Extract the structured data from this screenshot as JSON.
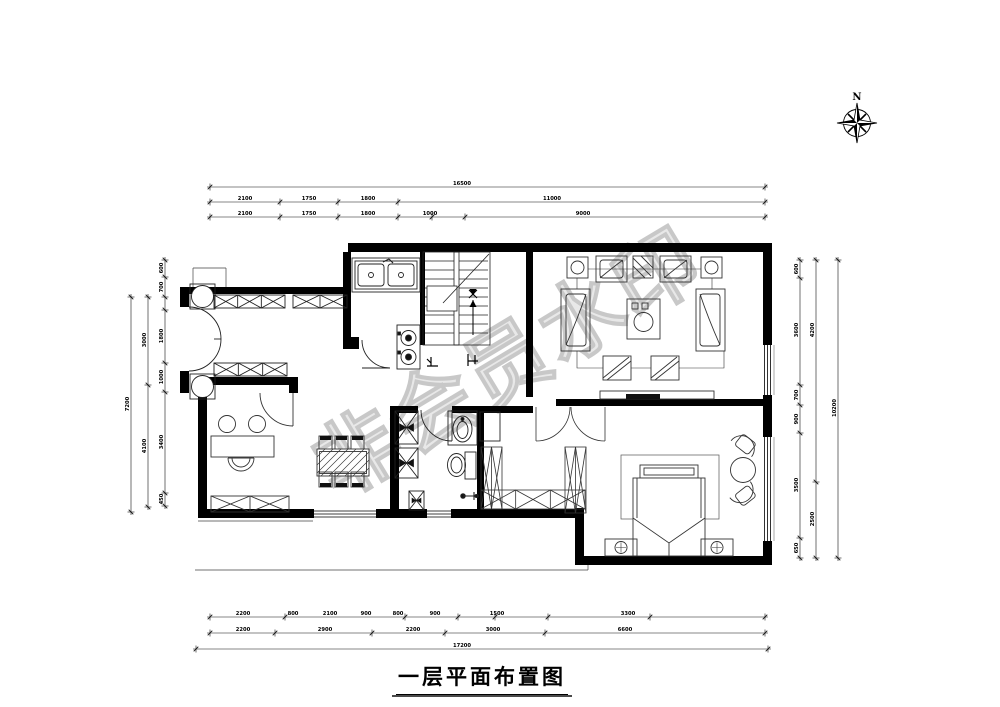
{
  "title": {
    "text": "一层平面布置图"
  },
  "compass": {
    "label": "N"
  },
  "watermark": {
    "text": "非会员水印"
  },
  "colors": {
    "line": "#000000",
    "furniture": "#333333",
    "watermark": "#c3c3c3"
  },
  "dimensions": {
    "lines": [
      {
        "o": "h",
        "y": 187,
        "a": 210,
        "b": 765,
        "ticks": [
          210,
          765
        ],
        "labels": [
          {
            "p": 462,
            "t": "16500"
          }
        ]
      },
      {
        "o": "h",
        "y": 202,
        "a": 210,
        "b": 765,
        "ticks": [
          210,
          280,
          338,
          398,
          765
        ],
        "labels": [
          {
            "p": 245,
            "t": "2100"
          },
          {
            "p": 309,
            "t": "1750"
          },
          {
            "p": 368,
            "t": "1800"
          },
          {
            "p": 552,
            "t": "11000"
          }
        ]
      },
      {
        "o": "h",
        "y": 217,
        "a": 210,
        "b": 765,
        "ticks": [
          210,
          280,
          338,
          398,
          432,
          465,
          765
        ],
        "labels": [
          {
            "p": 245,
            "t": "2100"
          },
          {
            "p": 309,
            "t": "1750"
          },
          {
            "p": 368,
            "t": "1800"
          },
          {
            "p": 430,
            "t": "1000"
          },
          {
            "p": 583,
            "t": "9000"
          }
        ]
      },
      {
        "o": "h",
        "y": 617,
        "a": 210,
        "b": 765,
        "ticks": [
          210,
          285,
          405,
          458,
          495,
          548,
          650,
          765
        ],
        "labels": [
          {
            "p": 243,
            "t": "2200"
          },
          {
            "p": 293,
            "t": "800"
          },
          {
            "p": 330,
            "t": "2100"
          },
          {
            "p": 366,
            "t": "900"
          },
          {
            "p": 398,
            "t": "800"
          },
          {
            "p": 435,
            "t": "900"
          },
          {
            "p": 497,
            "t": "1500"
          },
          {
            "p": 628,
            "t": "3300"
          }
        ]
      },
      {
        "o": "h",
        "y": 633,
        "a": 210,
        "b": 765,
        "ticks": [
          210,
          275,
          372,
          445,
          545,
          765
        ],
        "labels": [
          {
            "p": 243,
            "t": "2200"
          },
          {
            "p": 325,
            "t": "2900"
          },
          {
            "p": 413,
            "t": "2200"
          },
          {
            "p": 493,
            "t": "3000"
          },
          {
            "p": 625,
            "t": "6600"
          }
        ]
      },
      {
        "o": "h",
        "y": 649,
        "a": 196,
        "b": 768,
        "ticks": [
          196,
          768
        ],
        "labels": [
          {
            "p": 462,
            "t": "17200"
          }
        ]
      },
      {
        "o": "v",
        "x": 165,
        "a": 260,
        "b": 506,
        "ticks": [
          260,
          277,
          297,
          310,
          363,
          392,
          493,
          506
        ],
        "labels": [
          {
            "p": 268,
            "t": "600"
          },
          {
            "p": 287,
            "t": "700"
          },
          {
            "p": 336,
            "t": "1800"
          },
          {
            "p": 377,
            "t": "1000"
          },
          {
            "p": 442,
            "t": "3400"
          },
          {
            "p": 499,
            "t": "450"
          }
        ]
      },
      {
        "o": "v",
        "x": 148,
        "a": 297,
        "b": 507,
        "ticks": [
          297,
          385,
          507
        ],
        "labels": [
          {
            "p": 340,
            "t": "3000"
          },
          {
            "p": 446,
            "t": "4100"
          }
        ]
      },
      {
        "o": "v",
        "x": 131,
        "a": 297,
        "b": 512,
        "ticks": [
          297,
          512
        ],
        "labels": [
          {
            "p": 404,
            "t": "7200"
          }
        ]
      },
      {
        "o": "v",
        "x": 800,
        "a": 260,
        "b": 558,
        "ticks": [
          260,
          278,
          385,
          405,
          433,
          538,
          558
        ],
        "labels": [
          {
            "p": 269,
            "t": "600"
          },
          {
            "p": 330,
            "t": "3600"
          },
          {
            "p": 395,
            "t": "700"
          },
          {
            "p": 419,
            "t": "900"
          },
          {
            "p": 485,
            "t": "3500"
          },
          {
            "p": 548,
            "t": "650"
          }
        ]
      },
      {
        "o": "v",
        "x": 816,
        "a": 260,
        "b": 558,
        "ticks": [
          260,
          482,
          558
        ],
        "labels": [
          {
            "p": 330,
            "t": "4200"
          },
          {
            "p": 519,
            "t": "2500"
          }
        ]
      },
      {
        "o": "v",
        "x": 838,
        "a": 260,
        "b": 558,
        "ticks": [
          260,
          558
        ],
        "labels": [
          {
            "p": 408,
            "t": "10200"
          }
        ]
      }
    ]
  }
}
